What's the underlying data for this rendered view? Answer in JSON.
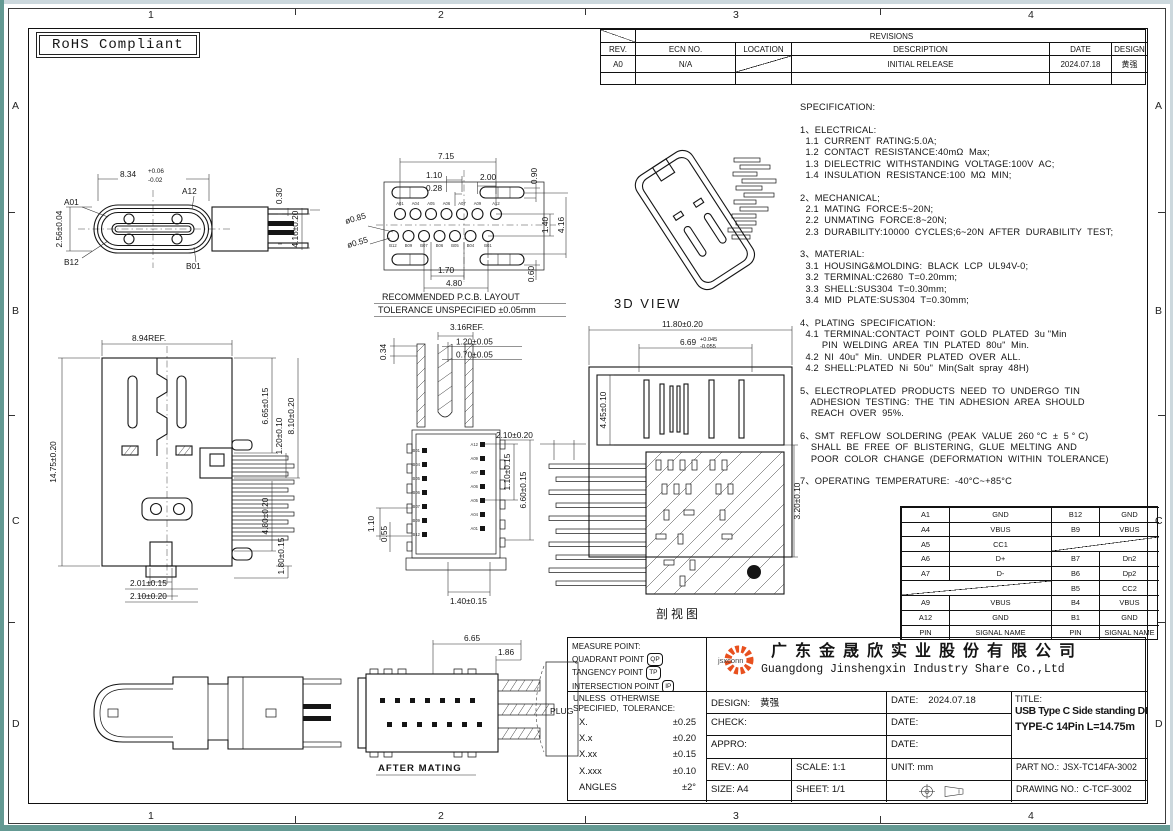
{
  "sheet": {
    "zone_numbers": [
      "1",
      "2",
      "3",
      "4"
    ],
    "zone_letters": [
      "A",
      "B",
      "C",
      "D"
    ],
    "rohs_label": "RoHS Compliant"
  },
  "revisions": {
    "title": "REVISIONS",
    "headers": [
      "REV.",
      "ECN  NO.",
      "LOCATION",
      "DESCRIPTION",
      "DATE",
      "DESIGN"
    ],
    "row": {
      "rev": "A0",
      "ecn": "N/A",
      "description": "INITIAL  RELEASE",
      "date": "2024.07.18",
      "design": "黄强"
    }
  },
  "specification": {
    "lines": [
      "SPECIFICATION:",
      "",
      "1、ELECTRICAL:",
      "  1.1  CURRENT  RATING:5.0A;",
      "  1.2  CONTACT  RESISTANCE:40mΩ  Max;",
      "  1.3  DIELECTRIC  WITHSTANDING  VOLTAGE:100V  AC;",
      "  1.4  INSULATION  RESISTANCE:100  MΩ  MIN;",
      "",
      "2、MECHANICAL;",
      "  2.1  MATING  FORCE:5~20N;",
      "  2.2  UNMATING  FORCE:8~20N;",
      "  2.3  DURABILITY:10000  CYCLES;6~20N  AFTER  DURABILITY  TEST;",
      "",
      "3、MATERIAL:",
      "  3.1  HOUSING&MOLDING:  BLACK  LCP  UL94V-0;",
      "  3.2  TERMINAL:C2680  T=0.20mm;",
      "  3.3  SHELL:SUS304  T=0.30mm;",
      "  3.4  MID  PLATE:SUS304  T=0.30mm;",
      "",
      "4、PLATING  SPECIFICATION:",
      "  4.1  TERMINAL:CONTACT  POINT  GOLD  PLATED  3u \"Min",
      "        PIN  WELDING  AREA  TIN  PLATED  80u\"  Min.",
      "  4.2  NI  40u\"  Min.  UNDER  PLATED  OVER  ALL.",
      "  4.2  SHELL:PLATED  Ni  50u\"  Min(Salt  spray  48H)",
      "",
      "5、ELECTROPLATED  PRODUCTS  NEED  TO  UNDERGO  TIN",
      "    ADHESION  TESTING:  THE  TIN  ADHESION  AREA  SHOULD",
      "    REACH  OVER  95%.",
      "",
      "6、SMT  REFLOW  SOLDERING  (PEAK  VALUE  260 °C  ±  5 ° C)",
      "    SHALL  BE  FREE  OF  BLISTERING,  GLUE  MELTING  AND",
      "    POOR  COLOR  CHANGE  (DEFORMATION  WITHIN  TOLERANCE)",
      "",
      "7、OPERATING  TEMPERATURE:  -40°C~+85°C"
    ]
  },
  "pin_table": {
    "rows": [
      [
        "A1",
        "GND",
        "B12",
        "GND"
      ],
      [
        "A4",
        "VBUS",
        "B9",
        "VBUS"
      ],
      [
        "A5",
        "CC1",
        "",
        ""
      ],
      [
        "A6",
        "D+",
        "B7",
        "Dn2"
      ],
      [
        "A7",
        "D-",
        "B6",
        "Dp2"
      ],
      [
        "",
        "",
        "B5",
        "CC2"
      ],
      [
        "A9",
        "VBUS",
        "B4",
        "VBUS"
      ],
      [
        "A12",
        "GND",
        "B1",
        "GND"
      ],
      [
        "PIN",
        "SIGNAL NAME",
        "PIN",
        "SIGNAL NAME"
      ]
    ]
  },
  "title_block": {
    "measure": {
      "l0": "MEASURE  POINT:",
      "l1": "QUADRANT  POINT",
      "b1": "QP",
      "l2": "TANGENCY  POINT",
      "b2": "TP",
      "l3": "INTERSECTION  POINT",
      "b3": "IP"
    },
    "tolerance": {
      "header": [
        "UNLESS  OTHERWISE",
        "SPECIFIED,  TOLERANCE:"
      ],
      "rows": [
        [
          "X.",
          "±0.25"
        ],
        [
          "X.x",
          "±0.20"
        ],
        [
          "X.xx",
          "±0.15"
        ],
        [
          "X.xxx",
          "±0.10"
        ],
        [
          "ANGLES",
          "±2°"
        ]
      ]
    },
    "company": {
      "logo": "jsxconn",
      "cn": "广东金晟欣实业股份有限公司",
      "en": "Guangdong Jinshengxin Industry Share Co.,Ltd"
    },
    "fields": {
      "design_label": "DESIGN:",
      "design_value": "黄强",
      "date1_label": "DATE:",
      "date1_value": "2024.07.18",
      "check_label": "CHECK:",
      "date2_label": "DATE:",
      "appro_label": "APPRO:",
      "date3_label": "DATE:",
      "rev": "REV.: A0",
      "scale": "SCALE: 1:1",
      "unit": "UNIT: mm",
      "part_label": "PART  NO.:",
      "part_value": "JSX-TC14FA-3002",
      "size": "SIZE: A4",
      "sheet": "SHEET: 1/1",
      "drawing_label": "DRAWING  NO.:",
      "drawing_value": "C-TCF-3002"
    },
    "title": {
      "label": "TITLE:",
      "line1": "USB Type C Side standing DIP",
      "line2": "TYPE-C 14Pin  L=14.75m"
    }
  },
  "views": {
    "front": {
      "a01": "A01",
      "a12": "A12",
      "b12": "B12",
      "b01": "B01",
      "w": "8.34",
      "w_up": "+0.06",
      "w_dn": "-0.02",
      "h": "2.56±0.04",
      "lead": "0.30",
      "total": "4.16±0.20"
    },
    "pcb": {
      "w": "7.15",
      "p1": "1.10",
      "p2": "0.28",
      "p3": "2.00",
      "v1": "0.90",
      "d1": "ø0.85",
      "d2": "ø0.55",
      "r1": "1.40",
      "r2": "4.16",
      "b1": "1.70",
      "b2": "4.80",
      "b3": "0.60",
      "cap1": "RECOMMENDED    P.C.B.  LAYOUT",
      "cap2": "TOLERANCE  UNSPECIFIED  ±0.05mm",
      "top_pins": [
        "A01",
        "A04",
        "A05",
        "A06",
        "A07",
        "A09",
        "A12"
      ],
      "bot_pins": [
        "B12",
        "B09",
        "B07",
        "B06",
        "B05",
        "B04",
        "B01"
      ]
    },
    "iso": {
      "label": "3D  VIEW"
    },
    "top": {
      "w": "8.94REF.",
      "h": "14.75±0.20",
      "r1": "6.65±0.15",
      "r2": "1.20±0.10",
      "r3": "8.10±0.20",
      "r4": "4.80±0.20",
      "r5": "1.80±0.15",
      "b1": "2.01±0.15",
      "b2": "2.10±0.20"
    },
    "side": {
      "t0": "0.34",
      "t1": "3.16REF.",
      "t2": "1.20±0.05",
      "t3": "0.70±0.05",
      "l1": "1.10",
      "l2": "0.55",
      "r1": "1.10±0.15",
      "r2": "6.60±0.15",
      "b1": "1.40±0.15",
      "left_pins": [
        "B01",
        "B04",
        "B05",
        "B06",
        "B07",
        "B09",
        "B12"
      ],
      "right_pins": [
        "A12",
        "A09",
        "A07",
        "A06",
        "A05",
        "A04",
        "A01"
      ]
    },
    "section": {
      "t1": "11.80±0.20",
      "t2": "6.69",
      "t2u": "+0.045",
      "t2d": "-0.055",
      "l1": "2.10±0.20",
      "l2": "4.45±0.10",
      "r1": "3.20±0.10",
      "caption": "剖视图"
    },
    "mating": {
      "d1": "6.65",
      "d2": "1.86",
      "plug": "PLUG",
      "caption": "AFTER  MATING"
    }
  }
}
